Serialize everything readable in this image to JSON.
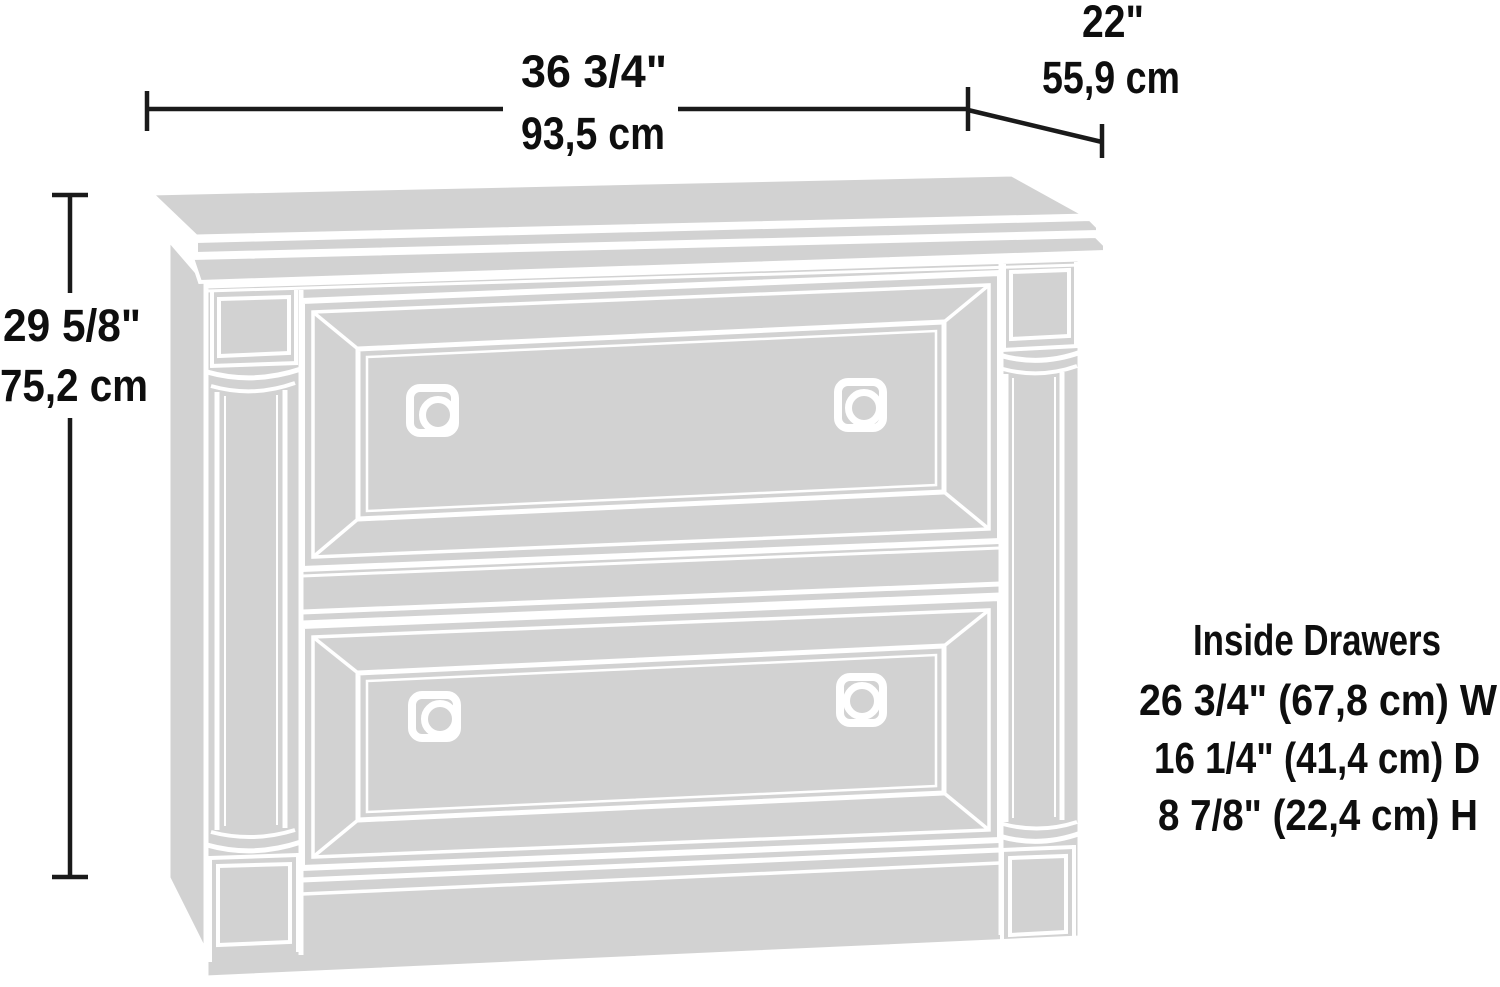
{
  "diagram": {
    "type": "furniture-dimension-drawing",
    "subject": "two-drawer lateral file cabinet line illustration",
    "colors": {
      "illustration_fill": "#d2d2d2",
      "seam_lines": "#ffffff",
      "dimension_lines": "#1a1a1a",
      "text": "#0e0e0e",
      "background": "#ffffff"
    }
  },
  "dimensions": {
    "width": {
      "imperial": "36 3/4\"",
      "metric": "93,5 cm"
    },
    "depth": {
      "imperial": "22\"",
      "metric": "55,9 cm"
    },
    "height": {
      "imperial": "29 5/8\"",
      "metric": "75,2 cm"
    }
  },
  "inside_drawers": {
    "title": "Inside Drawers",
    "lines": [
      "26 3/4\" (67,8 cm) W",
      "16 1/4\" (41,4 cm) D",
      "8 7/8\" (22,4 cm) H"
    ]
  }
}
